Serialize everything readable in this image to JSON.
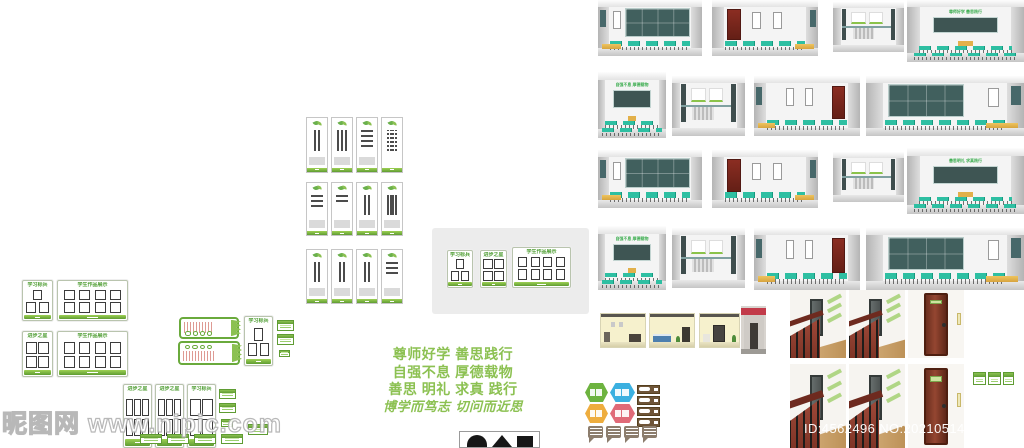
{
  "page": {
    "watermark_text": "昵图网 www.nipic.com",
    "photo_id_text": "ID:4562496 NO:20210514145541643128"
  },
  "slogan": {
    "lines": [
      "尊师好学 善思践行",
      "自强不息 厚德载物",
      "善思 明礼 求真 践行",
      "博学而笃志 切问而近思"
    ]
  },
  "board_titles": {
    "study_star": "学习标兵",
    "progress_star": "进步之星",
    "student_works": "学生作品展示"
  },
  "classroom_texts": {
    "respect": "尊师好学 善思践行",
    "selfimprove": "自强不息 厚德载物",
    "motto3": "善思明礼 求真践行"
  },
  "colors": {
    "accent_green": "#6aaa3c",
    "slogan_green": "#8cc152",
    "desk_teal": "#2ebfa2",
    "blackboard": "#3e5553",
    "platform_yellow": "#e7bb54",
    "door_red": "#7c2a1f",
    "wood_door_brown": "#7a3a28",
    "bar_brown": "#6f5538",
    "hexagons": [
      "#6db33f",
      "#3bb0e0",
      "#eead3e",
      "#e06a78"
    ]
  }
}
